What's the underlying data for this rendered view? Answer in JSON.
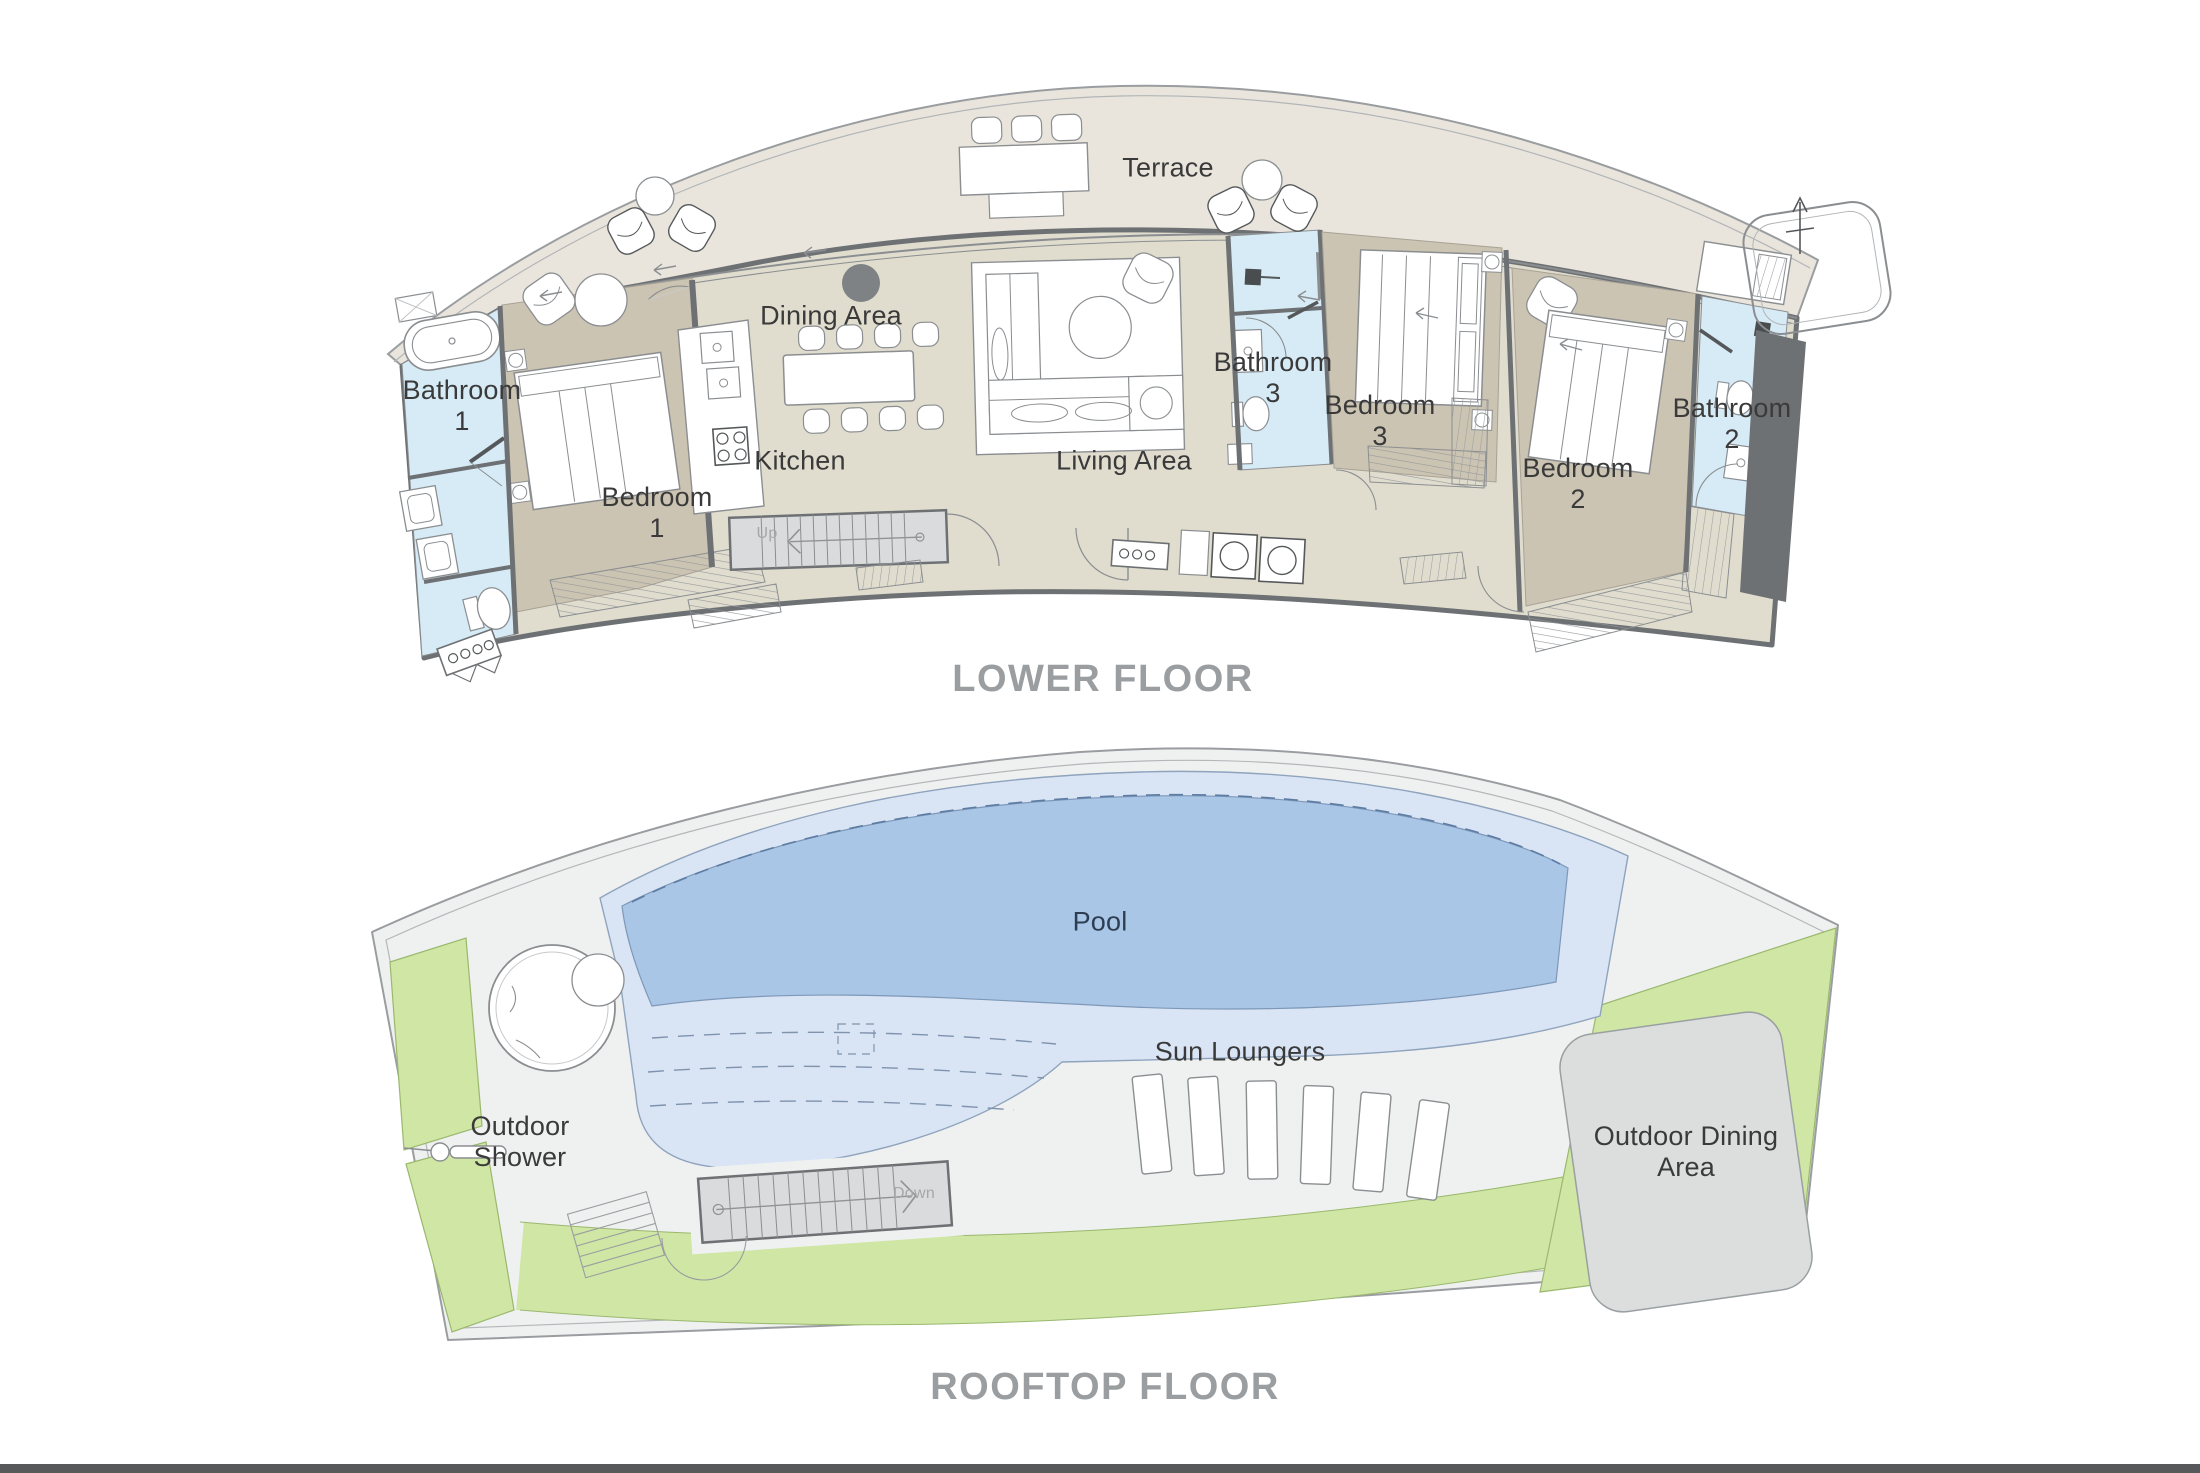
{
  "document": {
    "type": "floor-plan",
    "floors": 2
  },
  "colors": {
    "background": "#ffffff",
    "terrace_floor": "#e9e5dc",
    "interior_floor": "#e0ddcf",
    "bedroom_floor": "#ccc4b2",
    "bathroom_floor": "#d7ebf6",
    "wall": "#6e7174",
    "pool_deep": "#a9c6e7",
    "pool_shallow": "#d9e4f4",
    "planter_green": "#cfe6a4",
    "rooftop_deck": "#eff1f1",
    "stair_fill": "#dadbdc",
    "outdoor_dining_fill": "#dcdedd",
    "caption_text": "#9b9ea0",
    "label_text": "#3a3a3a",
    "footer_bar": "#56585a"
  },
  "lower_floor": {
    "caption": "LOWER FLOOR",
    "labels": {
      "terrace": "Terrace",
      "dining": "Dining Area",
      "kitchen": "Kitchen",
      "living": "Living Area",
      "bedroom1": "Bedroom\n1",
      "bedroom2": "Bedroom\n2",
      "bedroom3": "Bedroom\n3",
      "bathroom1": "Bathroom\n1",
      "bathroom2": "Bathroom\n2",
      "bathroom3": "Bathroom\n3",
      "stairs_up": "Up"
    }
  },
  "rooftop_floor": {
    "caption": "ROOFTOP FLOOR",
    "labels": {
      "pool": "Pool",
      "sun_loungers": "Sun Loungers",
      "outdoor_shower": "Outdoor\nShower",
      "outdoor_dining": "Outdoor Dining\nArea",
      "stairs_down": "Down"
    }
  }
}
